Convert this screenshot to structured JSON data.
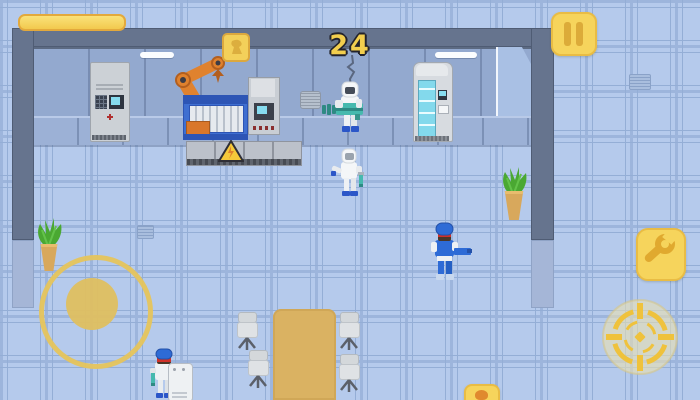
{
  "hud": {
    "score": "24",
    "progress_bar": {
      "value_percent": 100,
      "fill_color": "#f2c94e",
      "border_color": "#e3a93c"
    },
    "buttons": {
      "pause": {
        "icon": "pause-icon",
        "color": "#f6d45c"
      },
      "wrench": {
        "icon": "wrench-icon",
        "color": "#f6d45c"
      },
      "aim": {
        "icon": "target-crosshair-icon",
        "color": "#efc23c"
      },
      "grenade": {
        "icon": "grenade-icon",
        "color": "#f6d45c",
        "note": "partially visible at bottom edge"
      }
    },
    "joystick": {
      "ring_color": "#e6c45c",
      "knob_color": "#dfc060"
    }
  },
  "scene": {
    "setting": "pixel-art laboratory room, top-down view",
    "colors": {
      "floor_tile": "#b5caec",
      "tile_grout": "#9db5dc",
      "back_wall": "#93a9cf",
      "dark_wall": "#66748e",
      "wall_cap": "#a5b6d7",
      "accent_yellow": "#f6d45c",
      "machine_blue": "#3f6fd1",
      "robot_arm_orange": "#e0822e",
      "gun_teal": "#46b9ae",
      "suit_white": "#f4f6f8",
      "engineer_blue": "#2e6bd6",
      "table_wood": "#dab262",
      "plant_green": "#4aa832",
      "pot_tan": "#d8a85c"
    },
    "entities": [
      "control-cabinet",
      "robotic-arm",
      "item-crate",
      "assembly-machine",
      "machine-console",
      "conveyor-platform",
      "warning-sign",
      "vending-machine",
      "door-alcove",
      "wall-light",
      "wall-vent",
      "floor-grate",
      "hazmat-scientist-with-gun",
      "hazmat-scientist",
      "blue-engineer",
      "worker-with-cart",
      "meeting-table",
      "office-chair",
      "potted-plant"
    ]
  }
}
